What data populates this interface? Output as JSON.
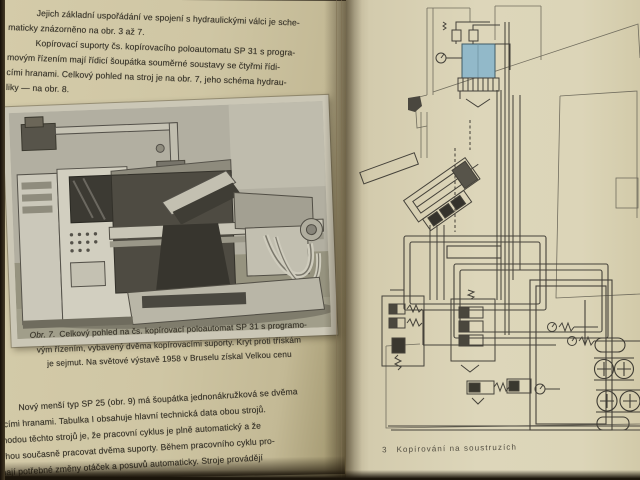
{
  "left_page": {
    "paragraph_top": {
      "lines": [
        "Jejich základní uspořádání ve spojení s hydraulickými válci je sche-",
        "maticky znázorněno na obr. 3 až 7.",
        "Kopírovací suporty čs. kopírovacího poloautomatu SP 31 s progra-",
        "movým řízením mají řídicí šoupátka souměrné soustavy se čtyřmi řídi-",
        "cími hranami. Celkový pohled na stroj je na obr. 7, jeho schéma hydrau-",
        "liky — na obr. 8."
      ]
    },
    "photo_caption": {
      "label": "Obr. 7.",
      "lines": [
        "Celkový pohled na čs. kopírovací poloautomat SP 31 s programo-",
        "vým řízením, vybavený dvěma kopírovacími suporty. Kryt proti třískám",
        "je sejmut. Na světové výstavě 1958 v Bruselu získal Velkou cenu"
      ]
    },
    "paragraph_bottom": {
      "lines": [
        "Nový menší typ SP 25 (obr. 9) má šoupátka jednonákružková se dvěma",
        "řídicími hranami. Tabulka I obsahuje hlavní technická data obou strojů.",
        "Výhodou těchto strojů je, že pracovní cyklus je plně automatický a že",
        "mohou současně pracovat dvěma suporty. Během pracovního cyklu pro-",
        "bíhají potřebné změny otáček a posuvů automaticky. Stroje provádějí"
      ]
    }
  },
  "right_page": {
    "figure_elements": [
      "oil-tank",
      "filter-comb",
      "pressure-gauge",
      "copying-support-cylinder",
      "control-valve-blocks",
      "pipe-loops",
      "gear-pumps",
      "electric-motors",
      "relief-springs"
    ],
    "footer": {
      "signature_number": "3",
      "title": "Kopírování na soustruzích"
    }
  },
  "colors": {
    "page_left": "#cfc6a4",
    "page_right": "#ddd6ba",
    "diagram_line": "#47443b",
    "tank_blue": "#92b9c9",
    "text": "#3a362b",
    "photo_gray": "#b2afa1",
    "background_edge": "#241d13"
  }
}
